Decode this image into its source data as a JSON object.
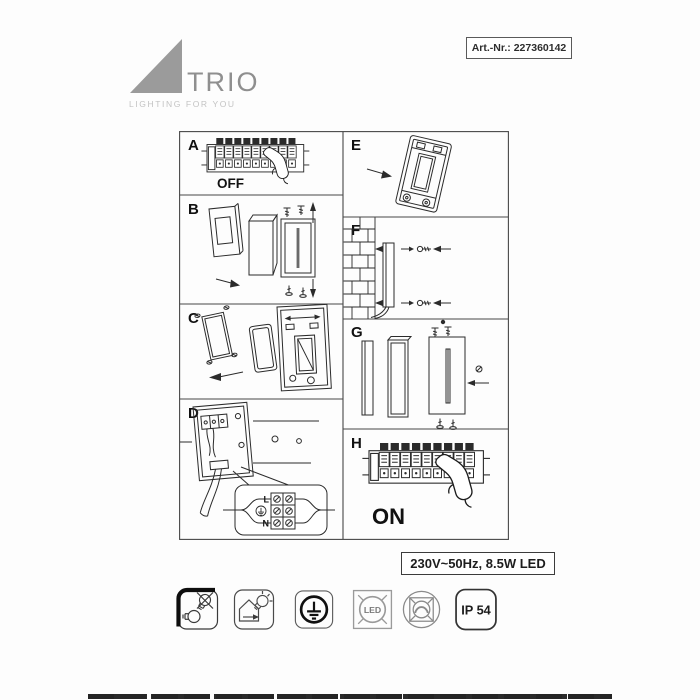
{
  "header": {
    "art_nr": "Art.-Nr.: 227360142"
  },
  "logo": {
    "brand": "TRIO",
    "tagline": "LIGHTING FOR YOU"
  },
  "panels": {
    "a": {
      "letter": "A",
      "state_label": "OFF"
    },
    "b": {
      "letter": "B"
    },
    "c": {
      "letter": "C"
    },
    "d": {
      "letter": "D",
      "terminals": {
        "live": "L",
        "neutral": "N"
      }
    },
    "e": {
      "letter": "E"
    },
    "f": {
      "letter": "F"
    },
    "g": {
      "letter": "G"
    },
    "h": {
      "letter": "H",
      "state_label": "ON"
    }
  },
  "spec": {
    "rating": "230V~50Hz, 8.5W LED"
  },
  "icons": [
    {
      "name": "bulb-replacement-icon"
    },
    {
      "name": "indoor-use-icon"
    },
    {
      "name": "protection-class-1-icon"
    },
    {
      "name": "led-not-replaceable-icon",
      "label": "LED"
    },
    {
      "name": "not-dimmable-icon"
    },
    {
      "name": "ip54-rating-icon",
      "label": "IP 54"
    }
  ],
  "colors": {
    "line": "#2b2b2b",
    "logo": "#9b9b9b",
    "paper": "#fdfdfd"
  }
}
